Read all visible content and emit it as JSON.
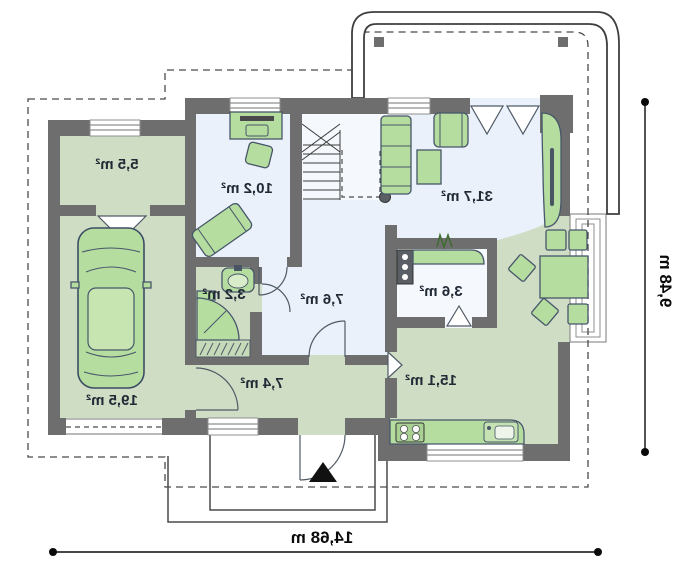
{
  "plan": {
    "title": "house-ground-floor-plan",
    "rooms": [
      {
        "id": "utility",
        "area": "5,5 m²"
      },
      {
        "id": "study",
        "area": "10,2 m²"
      },
      {
        "id": "living",
        "area": "31,7 m²"
      },
      {
        "id": "bathroom",
        "area": "3,2 m²"
      },
      {
        "id": "hall",
        "area": "7,6 m²"
      },
      {
        "id": "pantry",
        "area": "3,6 m²"
      },
      {
        "id": "garage",
        "area": "19,5 m²"
      },
      {
        "id": "corridor",
        "area": "7,4 m²"
      },
      {
        "id": "kitchen",
        "area": "15,1 m²"
      }
    ],
    "dimensions": {
      "width_label": "14,68 m",
      "height_label": "9,48 m"
    },
    "colors": {
      "wall": "#6e6e6e",
      "floor_green": "#cfddc5",
      "floor_blue": "#eaf1fa",
      "floor_white": "#f5f8fd",
      "furniture": "#b6dda0",
      "furniture_stroke": "#47566a",
      "appliance": "#5a5f66",
      "closet": "#c6d9b8",
      "dash": "#4a4a4a",
      "label": "#222a36",
      "dimension": "#0a0a0a"
    }
  }
}
